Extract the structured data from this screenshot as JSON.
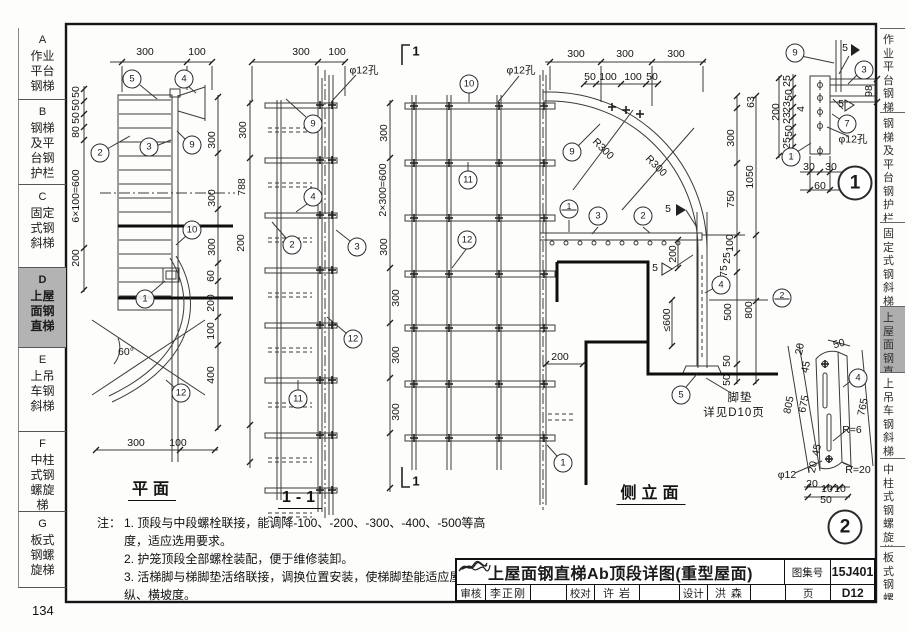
{
  "page": {
    "number": "134"
  },
  "sidebar": {
    "tabs": [
      {
        "letter": "A",
        "label": "作业平台钢梯",
        "lines": [
          "作业",
          "平台",
          "钢梯"
        ],
        "active": false
      },
      {
        "letter": "B",
        "label": "钢梯及平台钢护栏",
        "lines": [
          "钢梯",
          "及平",
          "台钢",
          "护栏"
        ],
        "active": false
      },
      {
        "letter": "C",
        "label": "固定式钢斜梯",
        "lines": [
          "固定",
          "式钢",
          "斜梯"
        ],
        "active": false
      },
      {
        "letter": "D",
        "label": "上屋面钢直梯",
        "lines": [
          "上屋",
          "面钢",
          "直梯"
        ],
        "active": true
      },
      {
        "letter": "E",
        "label": "上吊车钢斜梯",
        "lines": [
          "上吊",
          "车钢",
          "斜梯"
        ],
        "active": false
      },
      {
        "letter": "F",
        "label": "中柱式钢螺旋梯",
        "lines": [
          "中柱",
          "式钢",
          "螺旋",
          "梯"
        ],
        "active": false
      },
      {
        "letter": "G",
        "label": "板式钢螺旋梯",
        "lines": [
          "板式",
          "钢螺",
          "旋梯"
        ],
        "active": false
      }
    ]
  },
  "right_edge": {
    "tabs": [
      {
        "text": "作业平台钢梯",
        "active": false
      },
      {
        "text": "钢梯及平台钢护栏",
        "active": false
      },
      {
        "text": "固定式钢斜梯",
        "active": false
      },
      {
        "text": "上屋面钢直梯",
        "active": true
      },
      {
        "text": "上吊车钢斜梯",
        "active": false
      },
      {
        "text": "中柱式钢螺旋梯",
        "active": false
      },
      {
        "text": "板式钢螺旋梯",
        "active": false
      }
    ]
  },
  "drawing": {
    "view_titles": {
      "plan": "平面",
      "section": "1-1",
      "elevation": "侧立面"
    },
    "labels": [
      {
        "t": "300",
        "x": 145,
        "y": 52
      },
      {
        "t": "100",
        "x": 197,
        "y": 52
      },
      {
        "t": "50",
        "x": 76,
        "y": 92,
        "r": -90
      },
      {
        "t": "50",
        "x": 76,
        "y": 105,
        "r": -90
      },
      {
        "t": "50",
        "x": 76,
        "y": 118,
        "r": -90
      },
      {
        "t": "80",
        "x": 76,
        "y": 132,
        "r": -90
      },
      {
        "t": "6×100=600",
        "x": 76,
        "y": 196,
        "r": -90
      },
      {
        "t": "200",
        "x": 76,
        "y": 258,
        "r": -90
      },
      {
        "t": "300",
        "x": 212,
        "y": 140,
        "r": -90
      },
      {
        "t": "300",
        "x": 212,
        "y": 198,
        "r": -90
      },
      {
        "t": "300",
        "x": 212,
        "y": 247,
        "r": -90
      },
      {
        "t": "60",
        "x": 211,
        "y": 276,
        "r": -90
      },
      {
        "t": "200",
        "x": 211,
        "y": 303,
        "r": -90
      },
      {
        "t": "100",
        "x": 211,
        "y": 331,
        "r": -90
      },
      {
        "t": "400",
        "x": 211,
        "y": 375,
        "r": -90
      },
      {
        "t": "300",
        "x": 136,
        "y": 443
      },
      {
        "t": "100",
        "x": 178,
        "y": 443
      },
      {
        "t": "60°",
        "x": 126,
        "y": 352
      },
      {
        "t": "平面",
        "x": 152,
        "y": 488,
        "c": "vtitle"
      },
      {
        "t": "300",
        "x": 301,
        "y": 52
      },
      {
        "t": "100",
        "x": 337,
        "y": 52
      },
      {
        "t": "φ12孔",
        "x": 364,
        "y": 70
      },
      {
        "t": "300",
        "x": 243,
        "y": 130,
        "r": -90
      },
      {
        "t": "788",
        "x": 242,
        "y": 187,
        "r": -90
      },
      {
        "t": "200",
        "x": 241,
        "y": 243,
        "r": -90
      },
      {
        "t": "300",
        "x": 384,
        "y": 133,
        "r": -90
      },
      {
        "t": "2×300=600",
        "x": 383,
        "y": 190,
        "r": -90
      },
      {
        "t": "300",
        "x": 384,
        "y": 247,
        "r": -90
      },
      {
        "t": "300",
        "x": 396,
        "y": 298,
        "r": -90
      },
      {
        "t": "300",
        "x": 396,
        "y": 355,
        "r": -90
      },
      {
        "t": "300",
        "x": 396,
        "y": 412,
        "r": -90
      },
      {
        "t": "1-1",
        "x": 300,
        "y": 499,
        "c": "vtitle"
      },
      {
        "t": "1",
        "x": 416,
        "y": 51,
        "c": "mark"
      },
      {
        "t": "1",
        "x": 416,
        "y": 481,
        "c": "mark"
      },
      {
        "t": "300",
        "x": 576,
        "y": 54
      },
      {
        "t": "300",
        "x": 625,
        "y": 54
      },
      {
        "t": "300",
        "x": 676,
        "y": 54
      },
      {
        "t": "50",
        "x": 590,
        "y": 77
      },
      {
        "t": "100",
        "x": 608,
        "y": 77
      },
      {
        "t": "100",
        "x": 633,
        "y": 77
      },
      {
        "t": "50",
        "x": 652,
        "y": 77
      },
      {
        "t": "φ12孔",
        "x": 521,
        "y": 70
      },
      {
        "t": "R300",
        "x": 603,
        "y": 149,
        "r": 45
      },
      {
        "t": "R300",
        "x": 656,
        "y": 166,
        "r": 45
      },
      {
        "t": "63",
        "x": 751,
        "y": 102,
        "r": -90
      },
      {
        "t": "300",
        "x": 731,
        "y": 138,
        "r": -90
      },
      {
        "t": "1050",
        "x": 750,
        "y": 177,
        "r": -90
      },
      {
        "t": "750",
        "x": 731,
        "y": 199,
        "r": -90
      },
      {
        "t": "100",
        "x": 730,
        "y": 243,
        "r": -90
      },
      {
        "t": "25",
        "x": 727,
        "y": 258,
        "r": -90
      },
      {
        "t": "75",
        "x": 724,
        "y": 271,
        "r": -90
      },
      {
        "t": "500",
        "x": 728,
        "y": 312,
        "r": -90
      },
      {
        "t": "800",
        "x": 749,
        "y": 310,
        "r": -90
      },
      {
        "t": "50",
        "x": 727,
        "y": 361,
        "r": -90
      },
      {
        "t": "50",
        "x": 727,
        "y": 380,
        "r": -90
      },
      {
        "t": "200",
        "x": 673,
        "y": 254,
        "r": -90
      },
      {
        "t": "≤600",
        "x": 667,
        "y": 320,
        "r": -90
      },
      {
        "t": "200",
        "x": 560,
        "y": 357
      },
      {
        "t": "5",
        "x": 668,
        "y": 209
      },
      {
        "t": "5",
        "x": 655,
        "y": 268
      },
      {
        "t": "脚垫",
        "x": 740,
        "y": 397,
        "c": "cn"
      },
      {
        "t": "详见D10页",
        "x": 734,
        "y": 412,
        "c": "cn"
      },
      {
        "t": "侧立面",
        "x": 651,
        "y": 492,
        "c": "vtitle"
      },
      {
        "t": "25",
        "x": 787,
        "y": 81,
        "r": -90
      },
      {
        "t": "50",
        "x": 789,
        "y": 95,
        "r": -90
      },
      {
        "t": "23",
        "x": 787,
        "y": 107,
        "r": -90
      },
      {
        "t": "4",
        "x": 801,
        "y": 109,
        "r": -90
      },
      {
        "t": "23",
        "x": 787,
        "y": 118,
        "r": -90
      },
      {
        "t": "50",
        "x": 789,
        "y": 131,
        "r": -90
      },
      {
        "t": "25",
        "x": 787,
        "y": 143,
        "r": -90
      },
      {
        "t": "200",
        "x": 776,
        "y": 112,
        "r": -90
      },
      {
        "t": "98",
        "x": 869,
        "y": 91,
        "r": -90
      },
      {
        "t": "30",
        "x": 809,
        "y": 167
      },
      {
        "t": "30",
        "x": 831,
        "y": 167
      },
      {
        "t": "60",
        "x": 820,
        "y": 186
      },
      {
        "t": "φ12孔",
        "x": 853,
        "y": 139
      },
      {
        "t": "5",
        "x": 845,
        "y": 48
      },
      {
        "t": "5",
        "x": 841,
        "y": 104
      },
      {
        "t": "20",
        "x": 800,
        "y": 349,
        "r": -78
      },
      {
        "t": "45",
        "x": 806,
        "y": 367,
        "r": -78
      },
      {
        "t": "675",
        "x": 804,
        "y": 404,
        "r": -78
      },
      {
        "t": "805",
        "x": 789,
        "y": 405,
        "r": -78
      },
      {
        "t": "45",
        "x": 817,
        "y": 450,
        "r": -78
      },
      {
        "t": "20",
        "x": 813,
        "y": 467,
        "r": -78
      },
      {
        "t": "50",
        "x": 839,
        "y": 344,
        "r": -15
      },
      {
        "t": "765",
        "x": 863,
        "y": 407,
        "r": -78
      },
      {
        "t": "R=6",
        "x": 852,
        "y": 430
      },
      {
        "t": "R=20",
        "x": 858,
        "y": 470
      },
      {
        "t": "φ12",
        "x": 787,
        "y": 475
      },
      {
        "t": "20",
        "x": 812,
        "y": 484
      },
      {
        "t": "10",
        "x": 827,
        "y": 489
      },
      {
        "t": "10",
        "x": 840,
        "y": 489
      },
      {
        "t": "50",
        "x": 826,
        "y": 500
      }
    ],
    "callouts": [
      {
        "n": "5",
        "x": 132,
        "y": 79
      },
      {
        "n": "4",
        "x": 184,
        "y": 79
      },
      {
        "n": "2",
        "x": 100,
        "y": 153
      },
      {
        "n": "3",
        "x": 149,
        "y": 147
      },
      {
        "n": "9",
        "x": 192,
        "y": 145
      },
      {
        "n": "10",
        "x": 192,
        "y": 230
      },
      {
        "n": "1",
        "x": 145,
        "y": 299
      },
      {
        "n": "12",
        "x": 181,
        "y": 393
      },
      {
        "n": "9",
        "x": 313,
        "y": 124
      },
      {
        "n": "4",
        "x": 313,
        "y": 197
      },
      {
        "n": "2",
        "x": 292,
        "y": 245
      },
      {
        "n": "3",
        "x": 357,
        "y": 247
      },
      {
        "n": "12",
        "x": 353,
        "y": 339
      },
      {
        "n": "11",
        "x": 298,
        "y": 399
      },
      {
        "n": "10",
        "x": 469,
        "y": 84
      },
      {
        "n": "11",
        "x": 468,
        "y": 180
      },
      {
        "n": "12",
        "x": 467,
        "y": 240
      },
      {
        "n": "9",
        "x": 572,
        "y": 152
      },
      {
        "n": "1",
        "x": 569,
        "y": 209,
        "type": "ref"
      },
      {
        "n": "3",
        "x": 598,
        "y": 216
      },
      {
        "n": "2",
        "x": 643,
        "y": 216
      },
      {
        "n": "4",
        "x": 721,
        "y": 285
      },
      {
        "n": "2",
        "x": 782,
        "y": 298,
        "type": "ref"
      },
      {
        "n": "5",
        "x": 681,
        "y": 395
      },
      {
        "n": "1",
        "x": 563,
        "y": 463
      },
      {
        "n": "9",
        "x": 795,
        "y": 53
      },
      {
        "n": "3",
        "x": 864,
        "y": 70
      },
      {
        "n": "7",
        "x": 847,
        "y": 124
      },
      {
        "n": "1",
        "x": 791,
        "y": 157
      },
      {
        "n": "4",
        "x": 858,
        "y": 378
      },
      {
        "n": "1",
        "x": 855,
        "y": 183,
        "type": "big"
      },
      {
        "n": "2",
        "x": 845,
        "y": 527,
        "type": "big"
      }
    ]
  },
  "notes": {
    "prefix": "注：",
    "items": [
      "1. 顶段与中段螺栓联接，能调降-100、-200、-300、-400、-500等高度，适应选用要求。",
      "2. 护笼顶段全部螺栓装配，便于维修装卸。",
      "3. 活梯脚与梯脚垫活络联接，调换位置安装，使梯脚垫能适应屋面纵、横坡度。"
    ]
  },
  "titleblock": {
    "title": "上屋面钢直梯Ab顶段详图(重型屋面)",
    "atlas_label": "图集号",
    "atlas_no": "15J401",
    "page_label": "页",
    "page_no": "D12",
    "fields": [
      {
        "label": "审核",
        "name": "李正刚"
      },
      {
        "label": "校对",
        "name": "许 岩"
      },
      {
        "label": "设计",
        "name": "洪 森"
      }
    ]
  }
}
